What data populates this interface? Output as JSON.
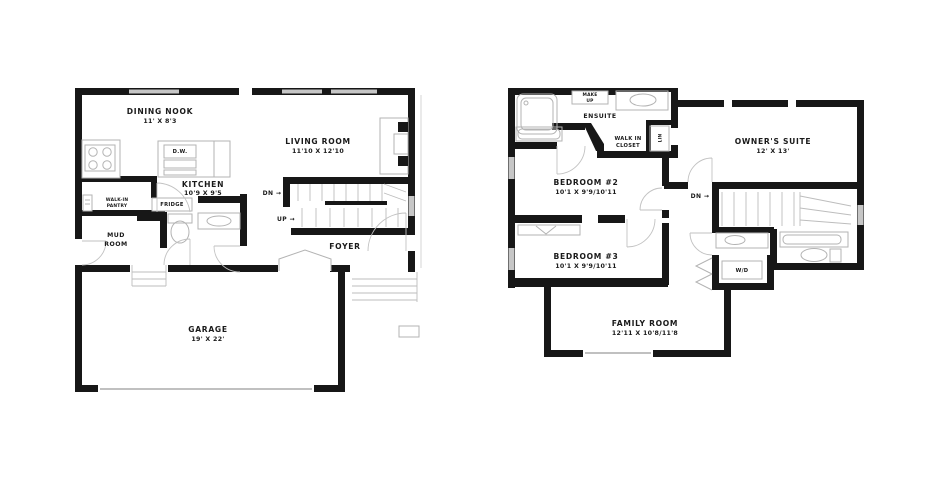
{
  "colors": {
    "background": "#ffffff",
    "wall": "#171717",
    "window": "#c6c6c6",
    "fixture_line": "#b3b3b3",
    "text": "#1a1a1a"
  },
  "first_floor": {
    "rooms": {
      "dining_nook": {
        "name": "DINING NOOK",
        "dims": "11' X 8'3"
      },
      "living_room": {
        "name": "LIVING ROOM",
        "dims": "11'10 X 12'10"
      },
      "kitchen": {
        "name": "KITCHEN",
        "dims": "10'9 X 9'5"
      },
      "walk_in_pantry": {
        "line1": "WALK-IN",
        "line2": "PANTRY"
      },
      "mud_room": {
        "line1": "MUD",
        "line2": "ROOM"
      },
      "foyer": {
        "name": "FOYER"
      },
      "garage": {
        "name": "GARAGE",
        "dims": "19' X 22'"
      }
    },
    "fixtures": {
      "dishwasher": "D.W.",
      "fridge": "FRIDGE"
    },
    "stairs": {
      "down": "DN →",
      "up": "UP →"
    }
  },
  "second_floor": {
    "rooms": {
      "ensuite": {
        "name": "ENSUITE"
      },
      "make_up": {
        "line1": "MAKE",
        "line2": "UP"
      },
      "walk_in_closet": {
        "line1": "WALK IN",
        "line2": "CLOSET"
      },
      "linen": {
        "name": "LIN"
      },
      "owners_suite": {
        "name": "OWNER'S SUITE",
        "dims": "12' X 13'"
      },
      "bedroom_2": {
        "name": "BEDROOM #2",
        "dims": "10'1 X 9'9/10'11"
      },
      "bedroom_3": {
        "name": "BEDROOM #3",
        "dims": "10'1 X 9'9/10'11"
      },
      "family_room": {
        "name": "FAMILY ROOM",
        "dims": "12'11 X 10'8/11'8"
      }
    },
    "fixtures": {
      "washer_dryer": "W/D"
    },
    "stairs": {
      "down": "DN →"
    }
  }
}
